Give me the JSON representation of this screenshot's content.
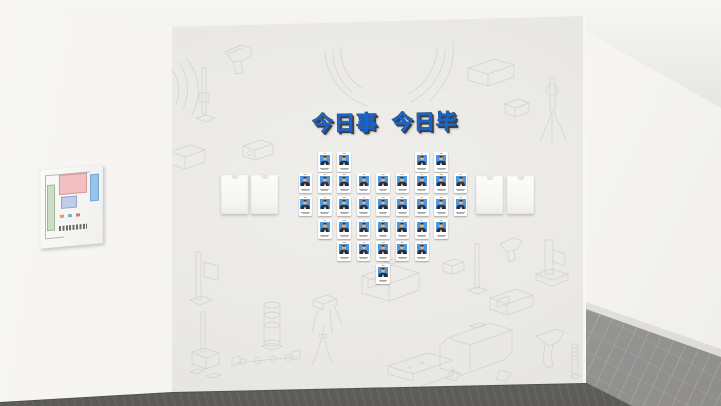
{
  "scene_type": "interior-culture-wall-render",
  "wall": {
    "title": "今日事 今日毕",
    "title_color": "#1566d4",
    "title_shadow_color": "#39404d"
  },
  "heart_board": {
    "description": "heart-shaped arrangement of staff photo badge cards",
    "card_total": 35,
    "center_x": 383,
    "spacing": 19.4,
    "card_w": 13.5,
    "card_h": 20,
    "rows": [
      {
        "y": 152,
        "offsets": [
          -3,
          -2,
          2,
          3
        ]
      },
      {
        "y": 173,
        "offsets": [
          -4,
          -3,
          -2,
          -1,
          0,
          1,
          2,
          3,
          4
        ]
      },
      {
        "y": 196,
        "offsets": [
          -4,
          -3,
          -2,
          -1,
          0,
          1,
          2,
          3,
          4
        ]
      },
      {
        "y": 219,
        "offsets": [
          -3,
          -2,
          -1,
          0,
          1,
          2,
          3
        ]
      },
      {
        "y": 241,
        "offsets": [
          -2,
          -1,
          0,
          1,
          2
        ]
      },
      {
        "y": 264,
        "offsets": [
          0
        ]
      }
    ],
    "card_colors": {
      "frame": "#ffffff",
      "photo_bg": "#4f97dd",
      "suit": "#2c2d34",
      "skin": "#dfb48d",
      "shirt": "#f2f2f0",
      "clip": "#cdb183",
      "text_line": "#a8a8a5"
    }
  },
  "side_panels": {
    "color": "#fbfbf9",
    "panels": [
      {
        "x": 221,
        "y": 175,
        "w": 27,
        "h": 39
      },
      {
        "x": 251,
        "y": 175,
        "w": 27,
        "h": 39
      },
      {
        "x": 476,
        "y": 176,
        "w": 27,
        "h": 38
      },
      {
        "x": 507,
        "y": 176,
        "w": 27,
        "h": 38
      }
    ]
  },
  "floor_plan_frame": {
    "colors": {
      "board": "#f9f9f7",
      "pink_zone": "#f1bfc2",
      "blue_strip": "#96c3e6",
      "blue_room": "#bfcde9",
      "green_strip": "#ccdec6",
      "outline": "#b7b6b3",
      "text": "#6a6a68"
    }
  },
  "palette": {
    "ceiling": "#f6f5f3",
    "left_wall": "#f3f2f0",
    "main_wall": "#eae9e6",
    "right_wall": "#f0efed",
    "front_floor_dark": "#5b5a58",
    "front_floor_light": "#9d9c9a",
    "marble_floor": "#a3a2a0",
    "sketch_line": "#d2d1ce"
  }
}
